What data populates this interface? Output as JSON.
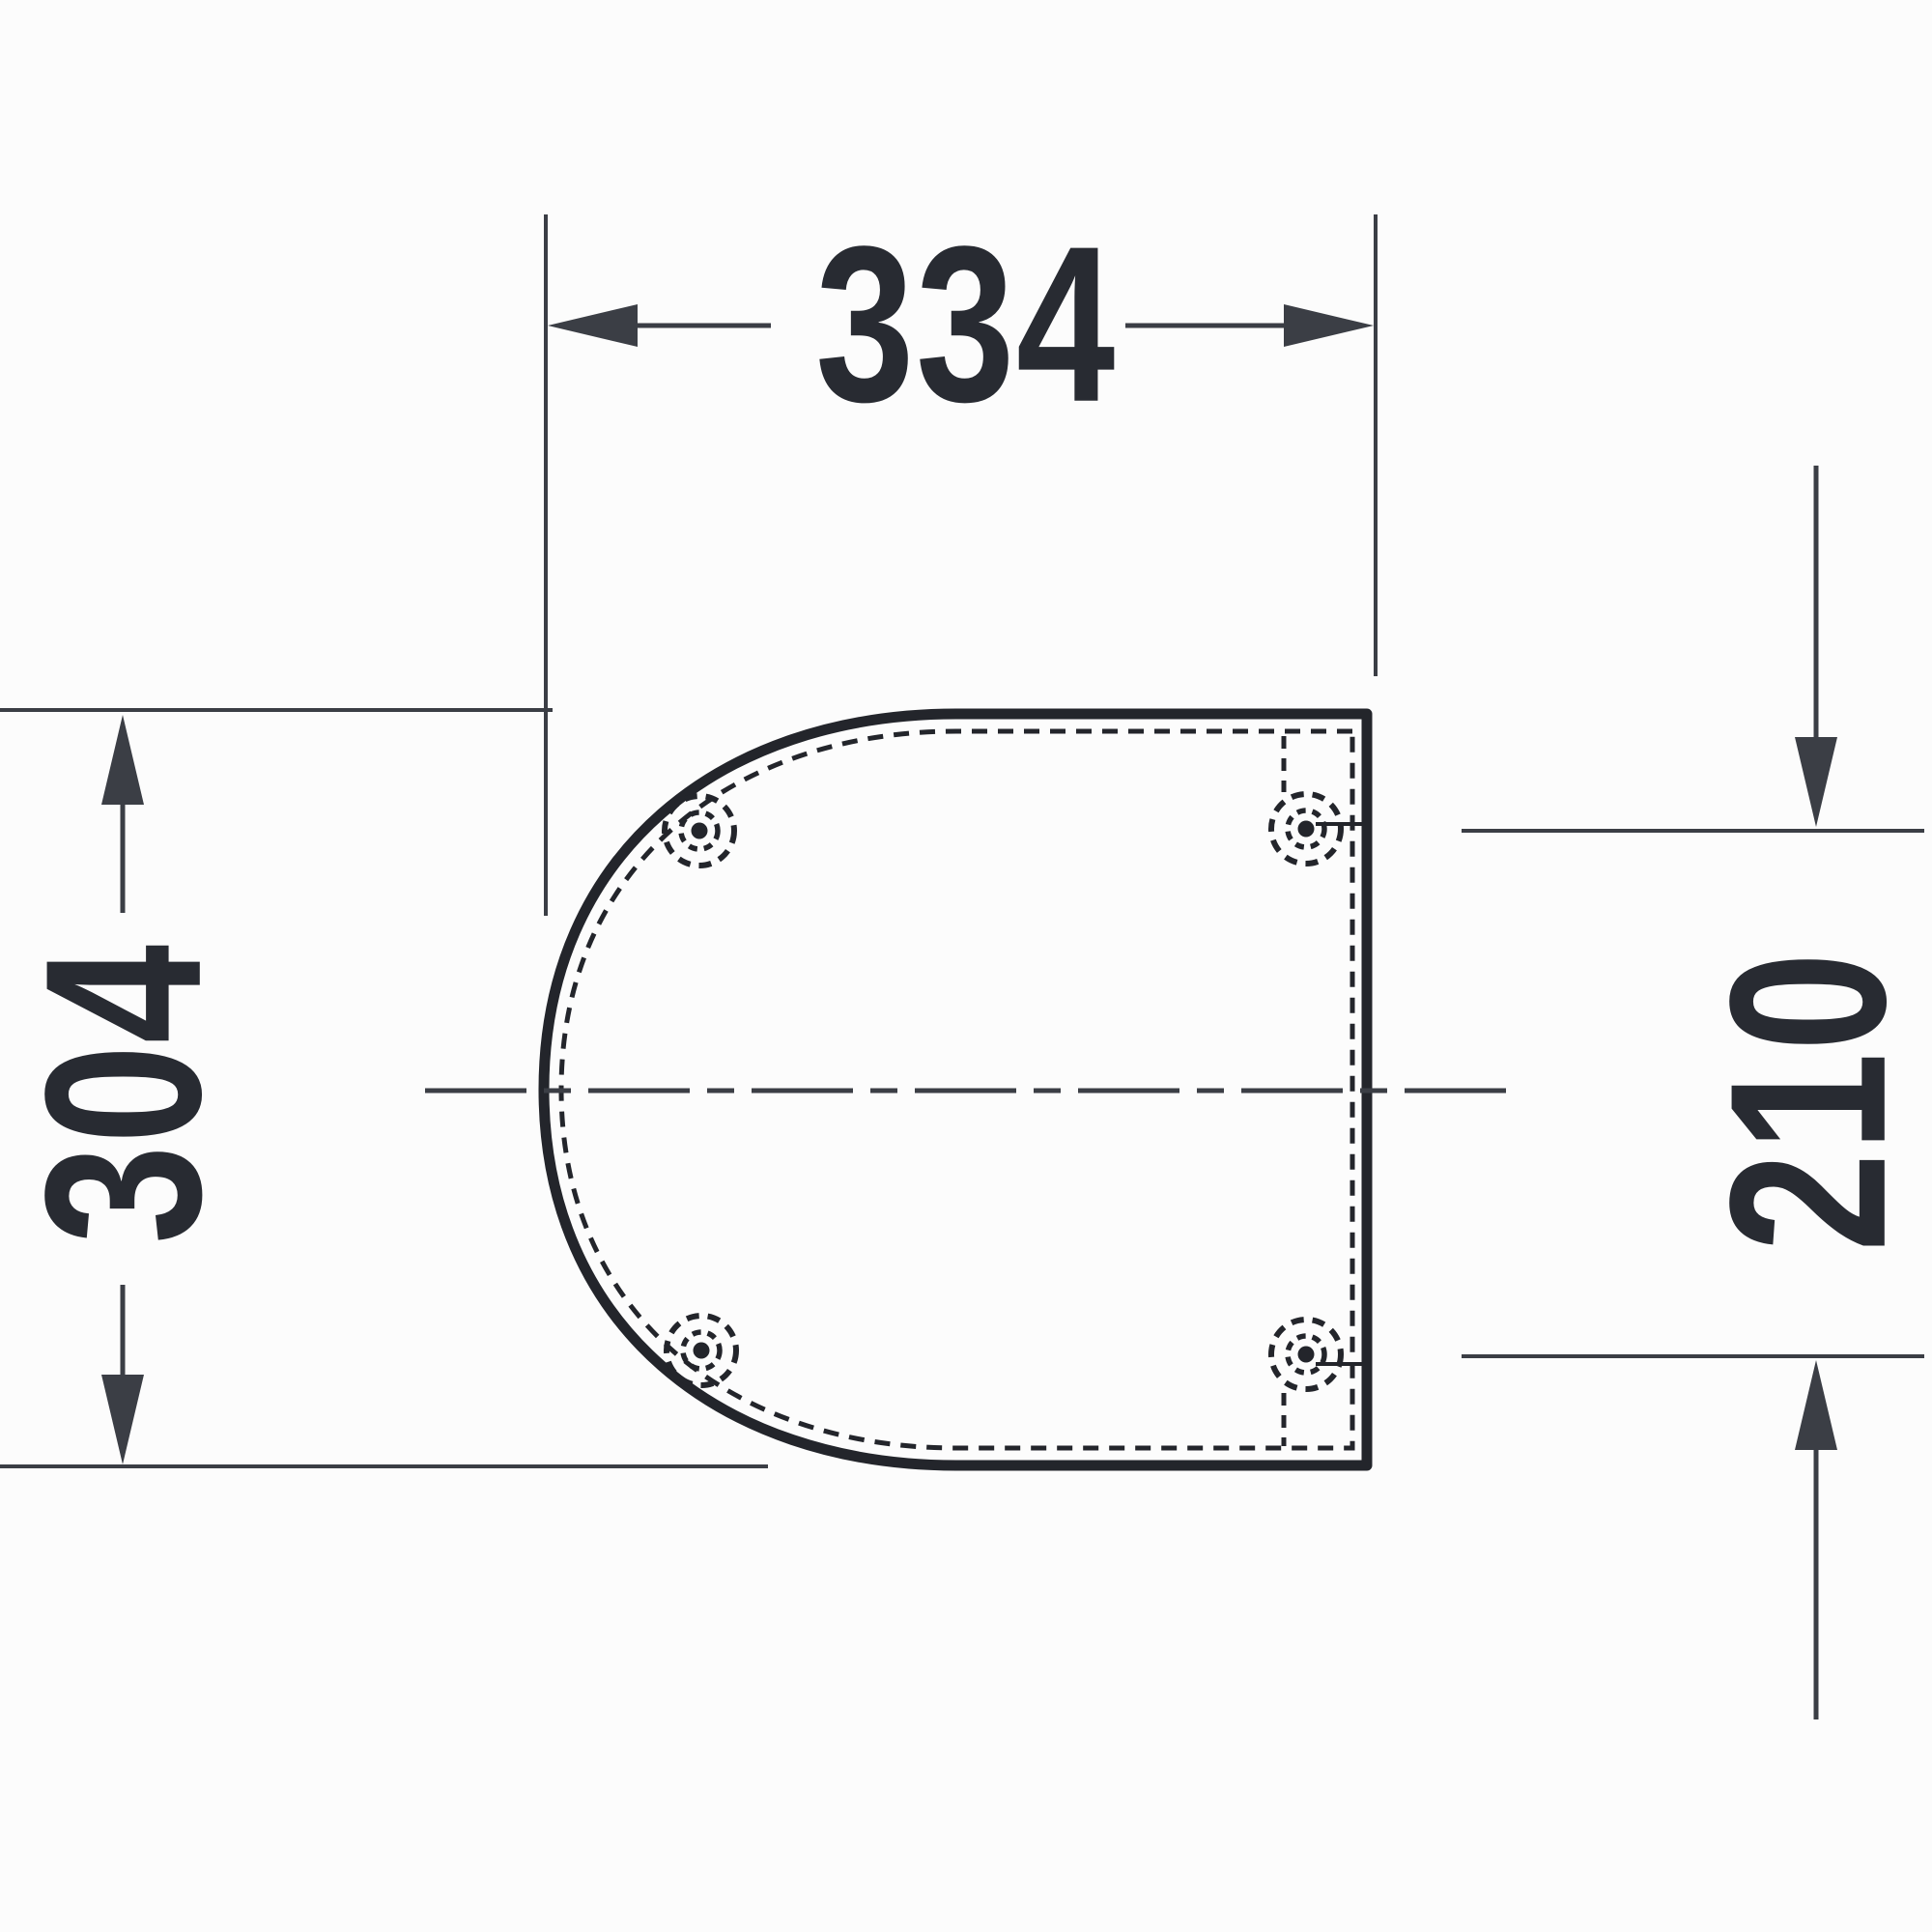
{
  "drawing": {
    "type": "technical-dimension-drawing",
    "subject": "toilet-seat-lid-top-view",
    "labels": {
      "width": "334",
      "height": "304",
      "hinge_spacing": "210"
    },
    "hinge_holes": {
      "count": 4
    },
    "colors": {
      "line": "#3b3e45",
      "outline": "#23252b",
      "text": "#282b32",
      "background": "#fcfcfc"
    }
  }
}
